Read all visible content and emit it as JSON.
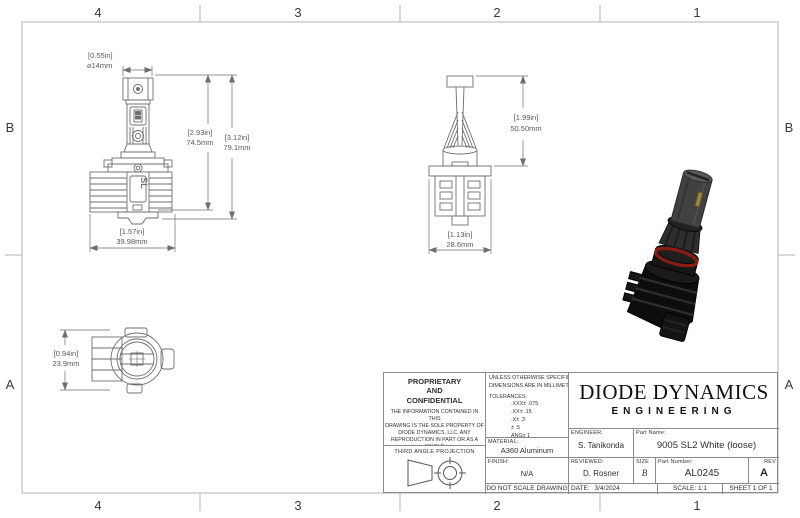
{
  "colors": {
    "line": "#6e6e6e",
    "frame": "#b4b4b4",
    "dim_text": "#5a5a5a",
    "oring_red": "#8a1d12"
  },
  "zones": {
    "top": [
      "4",
      "3",
      "2",
      "1"
    ],
    "bottom": [
      "4",
      "3",
      "2",
      "1"
    ],
    "left": [
      "B",
      "A"
    ],
    "right": [
      "B",
      "A"
    ]
  },
  "views": {
    "front": {
      "heatsink_logo": "SL",
      "dim_diameter_in": "[0.55in]",
      "dim_diameter_mm": "⌀14mm",
      "dim_height_inner_in": "[2.93in]",
      "dim_height_inner_mm": "74.5mm",
      "dim_height_outer_in": "[3.12in]",
      "dim_height_outer_mm": "79.1mm",
      "dim_width_in": "[1.57in]",
      "dim_width_mm": "39.98mm"
    },
    "side": {
      "dim_height_in": "[1.99in]",
      "dim_height_mm": "50.50mm",
      "dim_width_in": "[1.13in]",
      "dim_width_mm": "28.6mm"
    },
    "top": {
      "dim_height_in": "[0.94in]",
      "dim_height_mm": "23.9mm"
    }
  },
  "title_block": {
    "proprietary": {
      "title": "PROPRIETARY\nAND\nCONFIDENTIAL",
      "body": "THE INFORMATION CONTAINED IN THIS\nDRAWING IS THE SOLE PROPERTY OF\nDIODE DYNAMICS, LLC.  ANY\nREPRODUCTION IN PART OR AS A WHOLE\nWITHOUT THE WRITTEN PERMISSION OF\nDIODE DYNAMICS, LLC. IS PROHIBITED."
    },
    "third_angle_label": "THIRD ANGLE PROJECTION",
    "tolerances": {
      "line1": "UNLESS OTHERWISE SPECIFIED:",
      "line2": "DIMENSIONS ARE IN MILLIMETERS",
      "line3": "TOLERANCES:",
      "line4": ".XXX± .075",
      "line5": ".XX± .15",
      "line6": ".X± .3",
      "line7": "± .5",
      "line8": "ANG± 1"
    },
    "material_label": "MATERIAL:",
    "material": "A360 Aluminum",
    "finish_label": "FINISH:",
    "finish": "N/A",
    "do_not_scale": "DO NOT SCALE DRAWING",
    "company": "DIODE DYNAMICS",
    "division": "ENGINEERING",
    "engineer_label": "ENGINEER:",
    "engineer": "S. Tanikonda",
    "reviewed_label": "REVIEWED:",
    "reviewed": "D. Rosner",
    "date_label": "DATE:",
    "date": "3/4/2024",
    "part_name_label": "Part Name:",
    "part_name": "9005 SL2 White (loose)",
    "size_label": "SIZE",
    "size": "B",
    "part_number_label": "Part Number:",
    "part_number": "AL0245",
    "rev_label": "REV",
    "rev": "A",
    "scale": "SCALE: 1:1",
    "sheet": "SHEET 1 OF 1"
  }
}
